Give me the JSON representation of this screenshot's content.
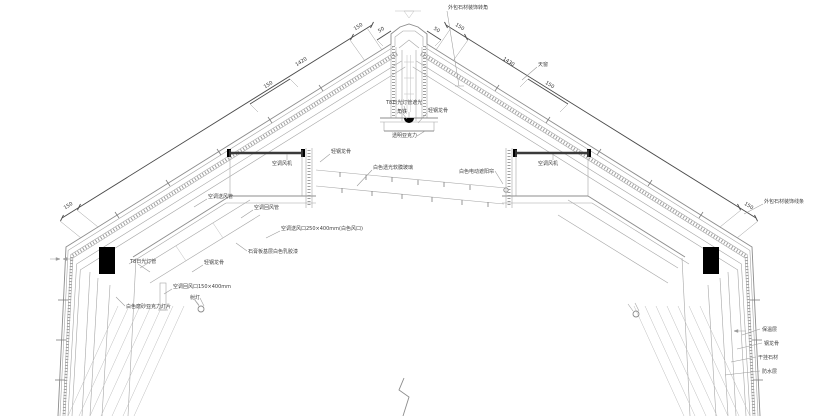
{
  "drawing": {
    "type": "architectural-roof-ridge-section-detail"
  },
  "colors": {
    "background": "#ffffff",
    "line_light": "#a6a6a6",
    "line_dark": "#3a3a3a",
    "dimension": "#4a4a4a",
    "text": "#3f3f3f",
    "solid_fill": "#000000"
  },
  "labels": {
    "top_corner": "外包石材装饰转角",
    "skylight": "天窗",
    "stone_trim_right": "外包石材装饰线条",
    "t8_tube_shield": "T8日光灯管遮光",
    "angle_iron": "角铁",
    "steel_keel_center": "轻钢龙骨",
    "clear_acrylic": "透明亚克力",
    "membrane": "白色透光软膜玻璃",
    "roller_blind": "白色电动遮阳帘",
    "ac_fan_left": "空调风机",
    "ac_fan_right": "空调风机",
    "steel_keel_left_upper": "轻钢龙骨",
    "ac_supply_duct": "空调送风管",
    "ac_return_duct": "空调回风管",
    "ac_supply_outlet": "空调送风口250×400mm(白色风口)",
    "gypsum_board": "石膏板基层白色乳胶漆",
    "steel_keel_left_lower": "轻钢龙骨",
    "ac_return_outlet": "空调回风口150×400mm",
    "spotlight_left": "射灯",
    "t8_tube": "T8日光灯管",
    "acrylic_panel": "白色磨砂亚克力灯片",
    "insulation": "保温层",
    "steel_keel_wall": "钢龙骨",
    "stone_cladding": "干挂石材",
    "waterproof": "防水层"
  },
  "dimensions": {
    "left_slope_main": "1420",
    "right_slope_main": "1430",
    "left_end_bottom": "150",
    "left_end_top": "150",
    "left_inner": "150",
    "right_end_bottom": "150",
    "right_end_top": "150",
    "right_inner": "150",
    "ridge_left": "50",
    "ridge_right": "50"
  }
}
